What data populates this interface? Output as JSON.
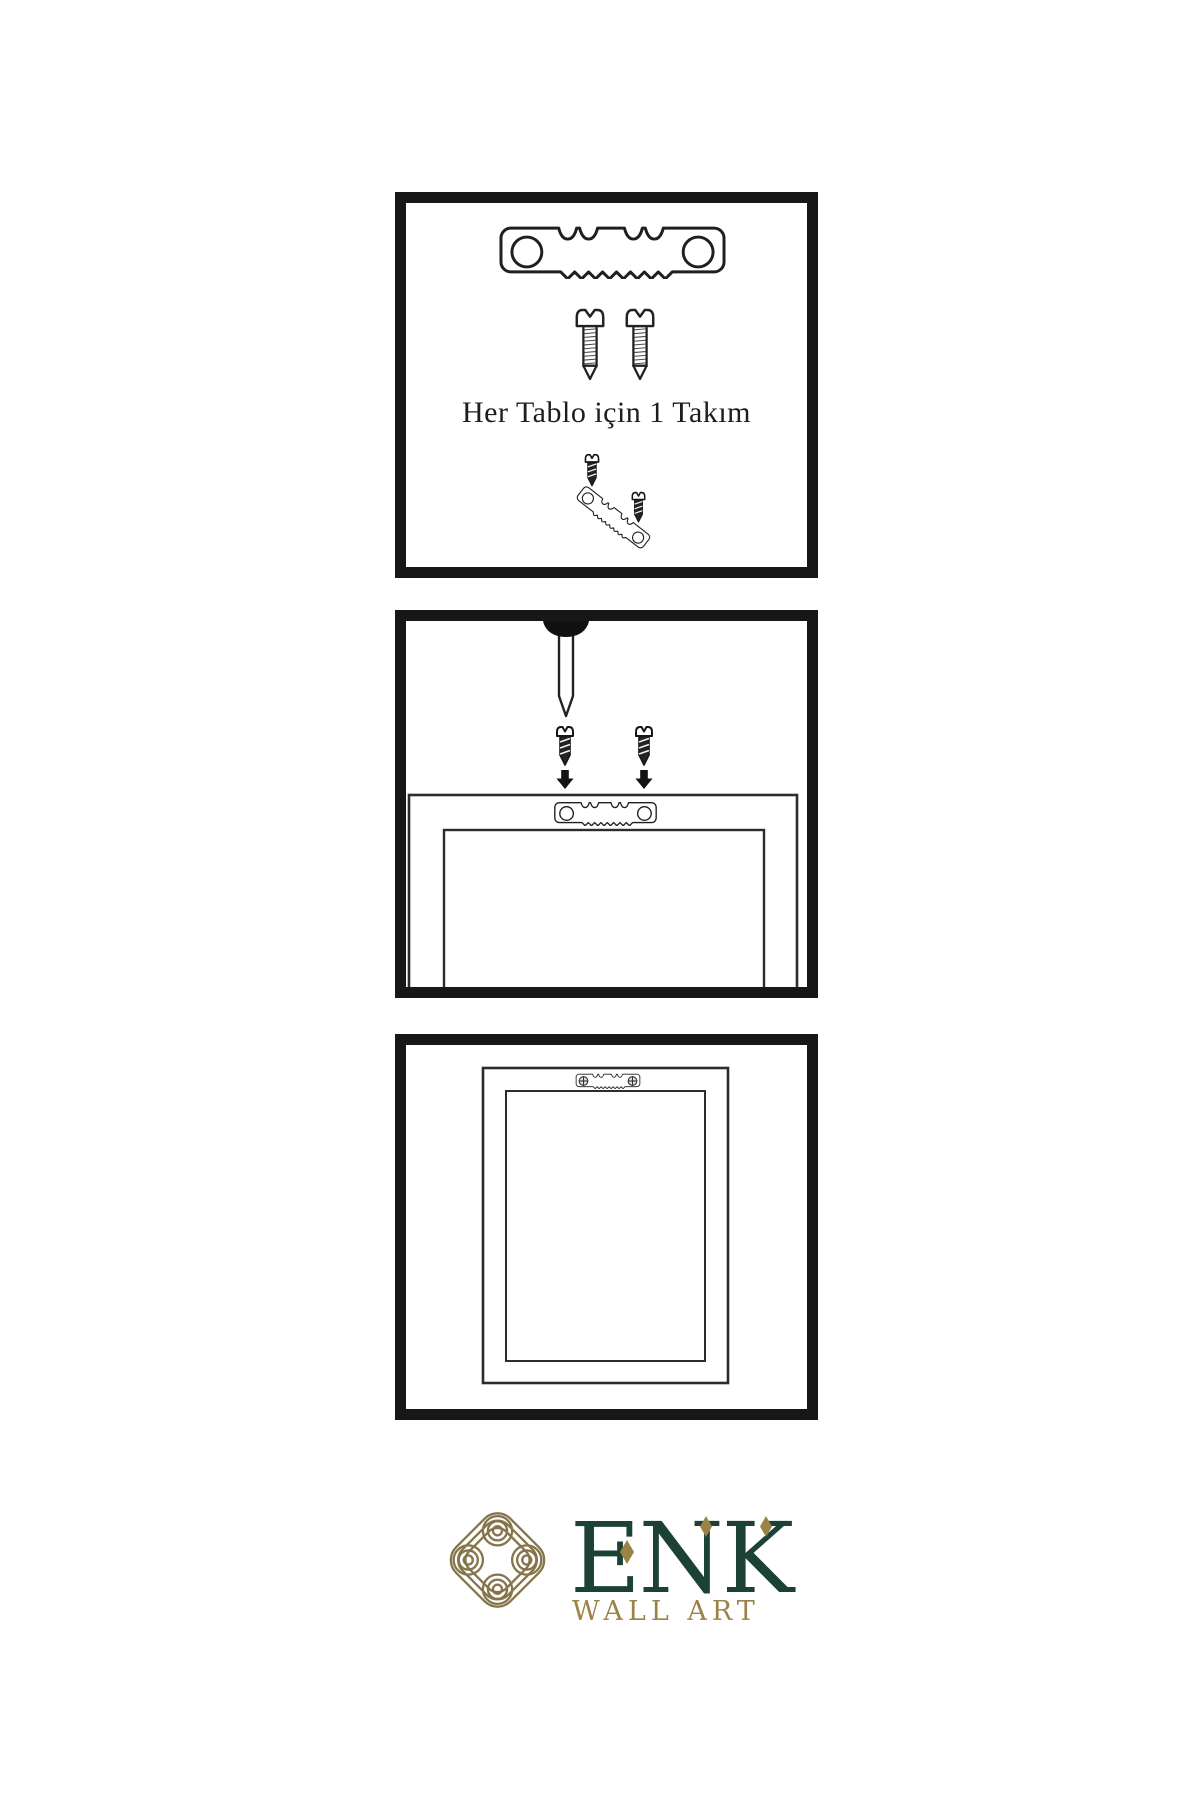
{
  "meta": {
    "type": "wall-art-hanging-instruction-sheet",
    "language": "tr",
    "background": "#ffffff",
    "line_color": "#171717"
  },
  "panels": [
    {
      "id": "hardware-kit",
      "caption": "Her Tablo için 1 Takım",
      "items": [
        "sawtooth-hanger-bar",
        "screw",
        "screw",
        "screw-above-hanger",
        "tilted-sawtooth-hanger",
        "screw-in-hanger-hole"
      ]
    },
    {
      "id": "attach-hanger-step",
      "caption": "",
      "items": [
        "wall-nail",
        "screw-with-down-arrow",
        "screw-with-down-arrow",
        "frame-back-outline",
        "sawtooth-hanger-on-frame"
      ]
    },
    {
      "id": "hung-frame-step",
      "caption": "",
      "items": [
        "frame-front-outline",
        "installed-sawtooth-hanger-with-screws"
      ]
    }
  ],
  "brand": {
    "name": "ENK",
    "tagline": "WALL ART",
    "logo": "interlaced-knot",
    "colors": {
      "green": "#1c4236",
      "gold": "#9b8347",
      "knot_gold": "#85754a"
    }
  }
}
